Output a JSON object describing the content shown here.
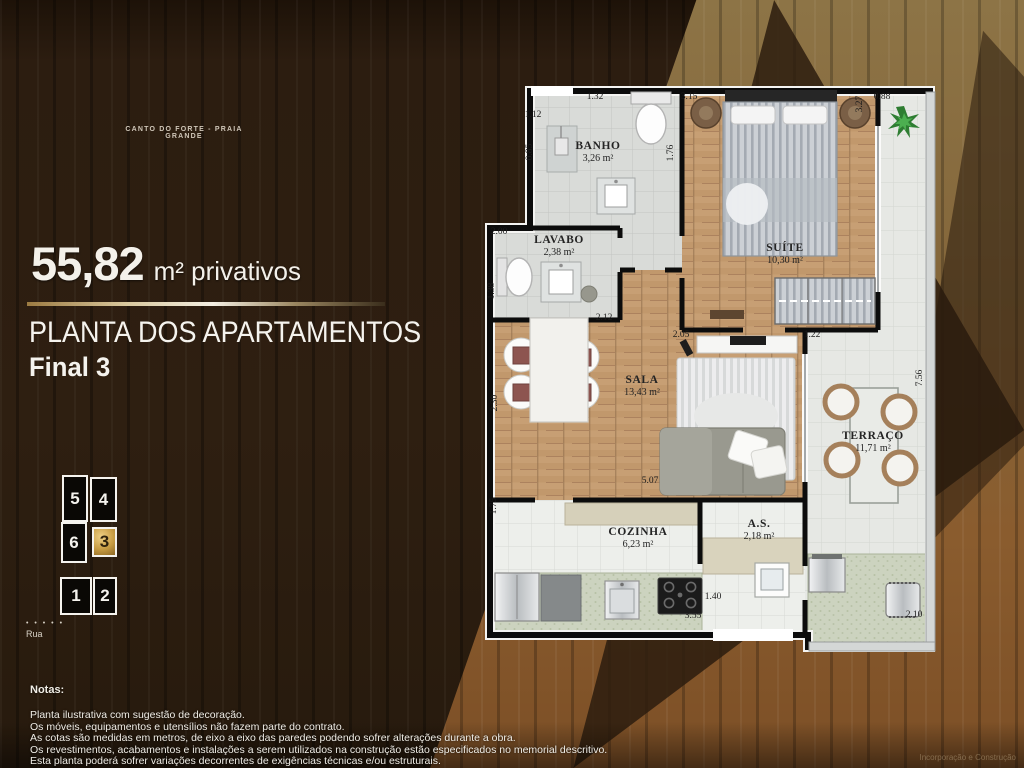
{
  "header": {
    "location": "CANTO DO FORTE - PRAIA GRANDE"
  },
  "summary": {
    "area_value": "55,82",
    "area_unit": "m² privativos"
  },
  "title": {
    "line1": "PLANTA DOS APARTAMENTOS",
    "line2": "Final 3"
  },
  "keyplan": {
    "street_dots": "• • • • •",
    "street_label": "Rua",
    "units": [
      {
        "label": "5",
        "x": 7,
        "y": 5,
        "w": 26,
        "h": 47,
        "highlight": false
      },
      {
        "label": "4",
        "x": 35,
        "y": 7,
        "w": 27,
        "h": 45,
        "highlight": false
      },
      {
        "label": "6",
        "x": 6,
        "y": 52,
        "w": 26,
        "h": 41,
        "highlight": false
      },
      {
        "label": "3",
        "x": 37,
        "y": 57,
        "w": 25,
        "h": 30,
        "highlight": true
      },
      {
        "label": "1",
        "x": 5,
        "y": 107,
        "w": 32,
        "h": 38,
        "highlight": false
      },
      {
        "label": "2",
        "x": 38,
        "y": 107,
        "w": 24,
        "h": 38,
        "highlight": false
      }
    ]
  },
  "plan": {
    "rooms": [
      {
        "name": "BANHO",
        "area": "3,26 m²",
        "x": 113,
        "y": 66
      },
      {
        "name": "SUÍTE",
        "area": "10,30 m²",
        "x": 300,
        "y": 168
      },
      {
        "name": "LAVABO",
        "area": "2,38 m²",
        "x": 74,
        "y": 160
      },
      {
        "name": "SALA",
        "area": "13,43 m²",
        "x": 157,
        "y": 300
      },
      {
        "name": "TERRAÇO",
        "area": "11,71 m²",
        "x": 388,
        "y": 356
      },
      {
        "name": "COZINHA",
        "area": "6,23 m²",
        "x": 153,
        "y": 452
      },
      {
        "name": "A.S.",
        "area": "2,18 m²",
        "x": 274,
        "y": 444
      }
    ],
    "dimensions": [
      {
        "v": "1.32",
        "x": 110,
        "y": 11
      },
      {
        "v": "1.12",
        "x": 48,
        "y": 29
      },
      {
        "v": "0.85",
        "x": 45,
        "y": 66,
        "rot": -90
      },
      {
        "v": "1.76",
        "x": 186,
        "y": 67,
        "rot": -90
      },
      {
        "v": "3.15",
        "x": 204,
        "y": 11
      },
      {
        "v": "3.27",
        "x": 375,
        "y": 18,
        "rot": -90
      },
      {
        "v": "0.88",
        "x": 397,
        "y": 11
      },
      {
        "v": "2.00",
        "x": 14,
        "y": 146
      },
      {
        "v": "1.38",
        "x": 7,
        "y": 205,
        "rot": -90
      },
      {
        "v": "2.12",
        "x": 119,
        "y": 232
      },
      {
        "v": "2.05",
        "x": 196,
        "y": 249
      },
      {
        "v": "1.22",
        "x": 327,
        "y": 249
      },
      {
        "v": "2.30",
        "x": 10,
        "y": 317,
        "rot": -90
      },
      {
        "v": "5.07",
        "x": 165,
        "y": 395
      },
      {
        "v": "7.56",
        "x": 435,
        "y": 292,
        "rot": -90
      },
      {
        "v": "1.75",
        "x": 9,
        "y": 420,
        "rot": -90
      },
      {
        "v": "1.40",
        "x": 228,
        "y": 511
      },
      {
        "v": "3.55",
        "x": 208,
        "y": 530
      },
      {
        "v": "2.10",
        "x": 429,
        "y": 529
      }
    ]
  },
  "notes": {
    "title": "Notas:",
    "lines": [
      "Planta ilustrativa com sugestão de decoração.",
      "Os móveis, equipamentos e utensílios não fazem parte do contrato.",
      "As cotas são medidas em metros, de eixo a eixo das paredes podendo sofrer alterações durante a obra.",
      "Os revestimentos, acabamentos e instalações a serem utilizados na construção estão especificados no memorial descritivo.",
      "Esta planta poderá sofrer variações decorrentes de exigências técnicas e/ou estruturais."
    ]
  },
  "footer": {
    "credit": "Incorporação e Construção"
  },
  "colors": {
    "accent_gold": "#c79c43",
    "wood_dark": "#2c1d10",
    "wood_light": "#8a5c2e",
    "plan_wall": "#0c0c0c",
    "plan_wood_floor": "#c79f74",
    "plan_tile_floor": "#d9dbd8",
    "plan_terrace_floor": "#e6e8e4",
    "plan_counter": "#ccd3bf"
  }
}
